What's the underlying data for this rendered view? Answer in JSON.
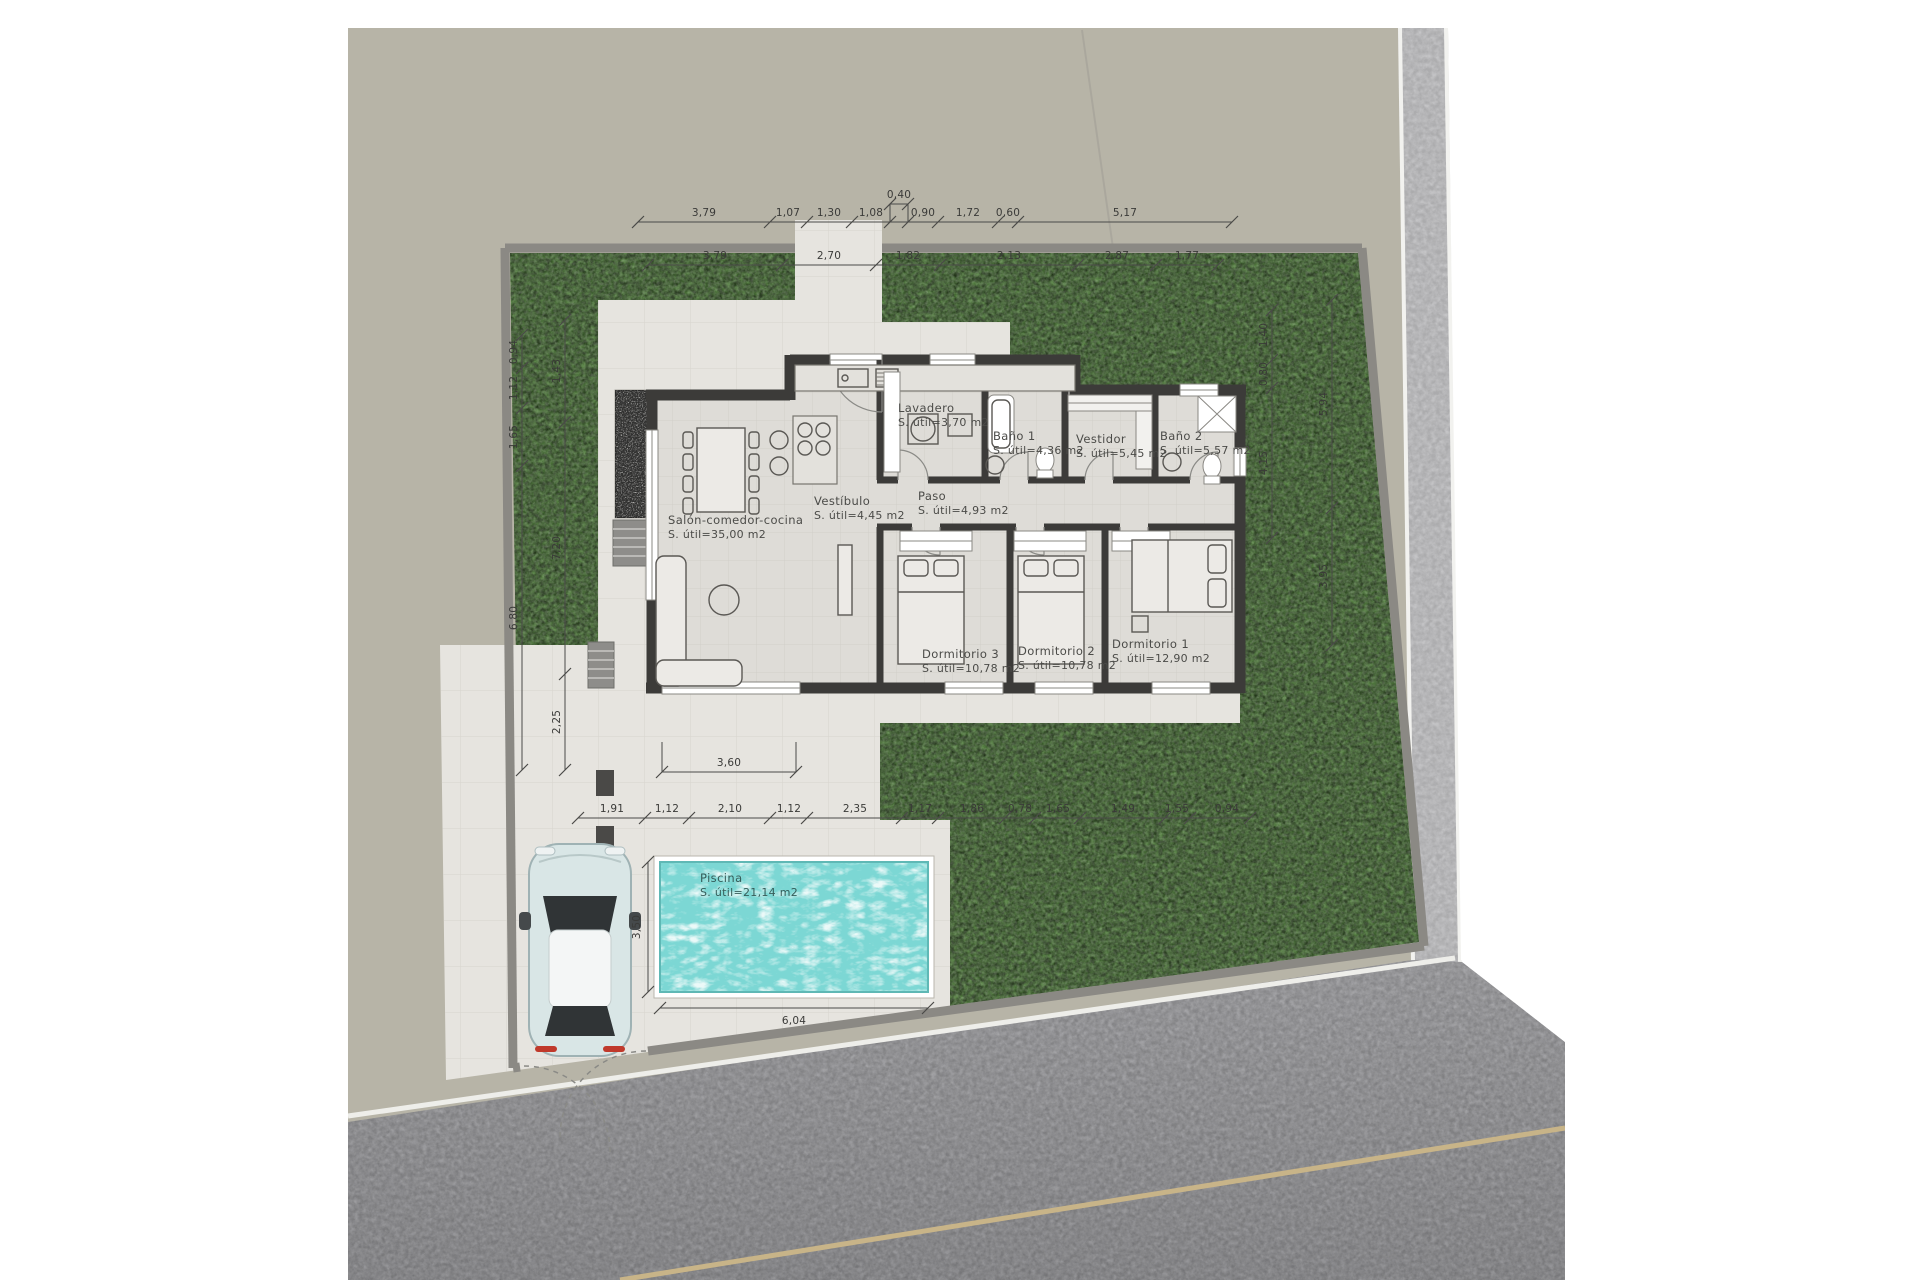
{
  "title": "Villa site floor plan",
  "rooms": {
    "salon": {
      "name": "Salón-comedor-cocina",
      "area": "S. útil=35,00 m2"
    },
    "vestibulo": {
      "name": "Vestíbulo",
      "area": "S. útil=4,45 m2"
    },
    "lavadero": {
      "name": "Lavadero",
      "area": "S. útil=3,70 m2"
    },
    "bano1": {
      "name": "Baño 1",
      "area": "S. útil=4,36 m2"
    },
    "vestidor": {
      "name": "Vestidor",
      "area": "S. útil=5,45 m2"
    },
    "bano2": {
      "name": "Baño 2",
      "area": "S. útil=5,57 m2"
    },
    "paso": {
      "name": "Paso",
      "area": "S. útil=4,93 m2"
    },
    "dorm3": {
      "name": "Dormitorio 3",
      "area": "S. útil=10,78 m2"
    },
    "dorm2": {
      "name": "Dormitorio 2",
      "area": "S. útil=10,78 m2"
    },
    "dorm1": {
      "name": "Dormitorio 1",
      "area": "S. útil=12,90 m2"
    },
    "piscina": {
      "name": "Piscina",
      "area": "S. útil=21,14 m2"
    }
  },
  "dimensions": {
    "top_row_upper": [
      "3,79",
      "1,07",
      "1,30",
      "1,08",
      "0,40",
      "0,90",
      "1,72",
      "0,60",
      "5,17"
    ],
    "top_row_lower": [
      "3,79",
      "2,70",
      "1,82",
      "2,13",
      "2,87",
      "1,77"
    ],
    "bottom_row": [
      "1,91",
      "1,12",
      "2,10",
      "1,12",
      "2,35",
      "1,17",
      "1,86",
      "0,78",
      "1,65",
      "1,49",
      "1,55",
      "0,94"
    ],
    "terrace_width": "3,60",
    "pool_width": "6,04",
    "pool_height": "3,50",
    "left_outer": [
      "0,94",
      "1,12",
      "1,65",
      "6,80"
    ],
    "left_inner": [
      "1,43",
      "7,20",
      "2,25"
    ],
    "right_inner": [
      "1,40",
      "0,80",
      "4,15"
    ],
    "right_outer": [
      "5,94",
      "3,95"
    ]
  },
  "colors": {
    "plot": "#b7b4a7",
    "grass": "#4e7a3a",
    "paving": "#e6e4df",
    "floor": "#dedcd7",
    "wall": "#3c3b39",
    "fence": "#8b8984",
    "water": "#7cd7d4",
    "road_vertical": "#c4c4c6",
    "asphalt": "#97979a",
    "road_center_line": "#c8b488"
  }
}
